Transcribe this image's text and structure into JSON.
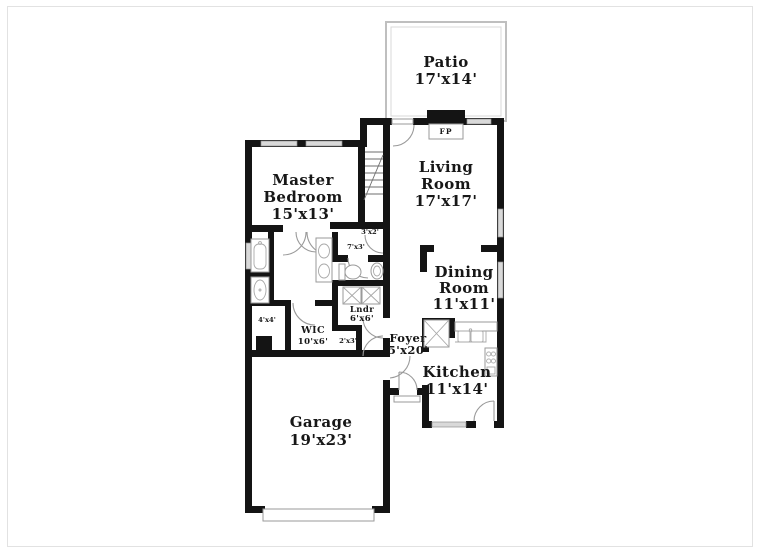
{
  "plan": {
    "title": "Residential first-floor plan",
    "rooms": {
      "patio": {
        "lines": [
          "Patio",
          "17'x14'"
        ]
      },
      "living": {
        "lines": [
          "Living",
          "Room",
          "17'x17'"
        ]
      },
      "master": {
        "lines": [
          "Master",
          "Bedroom",
          "15'x13'"
        ]
      },
      "dining": {
        "lines": [
          "Dining",
          "Room",
          "11'x11'"
        ]
      },
      "kitchen": {
        "lines": [
          "Kitchen",
          "11'x14'"
        ]
      },
      "garage": {
        "lines": [
          "Garage",
          "19'x23'"
        ]
      },
      "foyer": {
        "lines": [
          "Foyer",
          "5'x20'"
        ]
      },
      "wic": {
        "lines": [
          "WIC",
          "10'x6'"
        ]
      },
      "laundry": {
        "lines": [
          "Lndr",
          "6'x6'"
        ]
      }
    },
    "small_labels": {
      "stair_closet": "3'x2'",
      "hall": "7'x3'",
      "coat_closet": "2'x3'",
      "linen": "4'x4'",
      "fireplace": "FP"
    },
    "colors": {
      "walls": "#141414",
      "windows": "#d9d9d9",
      "fixture_lines": "#9a9a9a",
      "background": "#ffffff"
    }
  }
}
